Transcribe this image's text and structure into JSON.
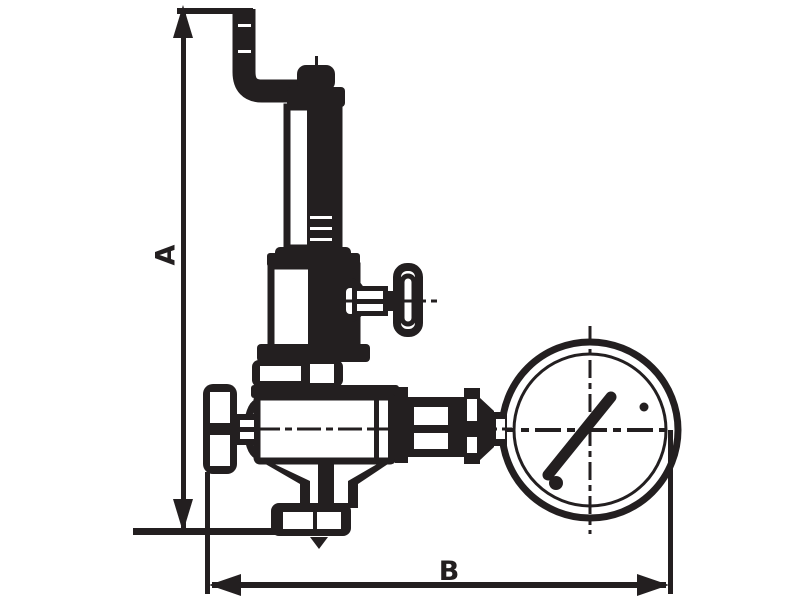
{
  "page": {
    "background_color": "#ffffff",
    "line_color": "#231f20"
  },
  "dimensions": {
    "vertical_label": "A",
    "horizontal_label": "B"
  }
}
